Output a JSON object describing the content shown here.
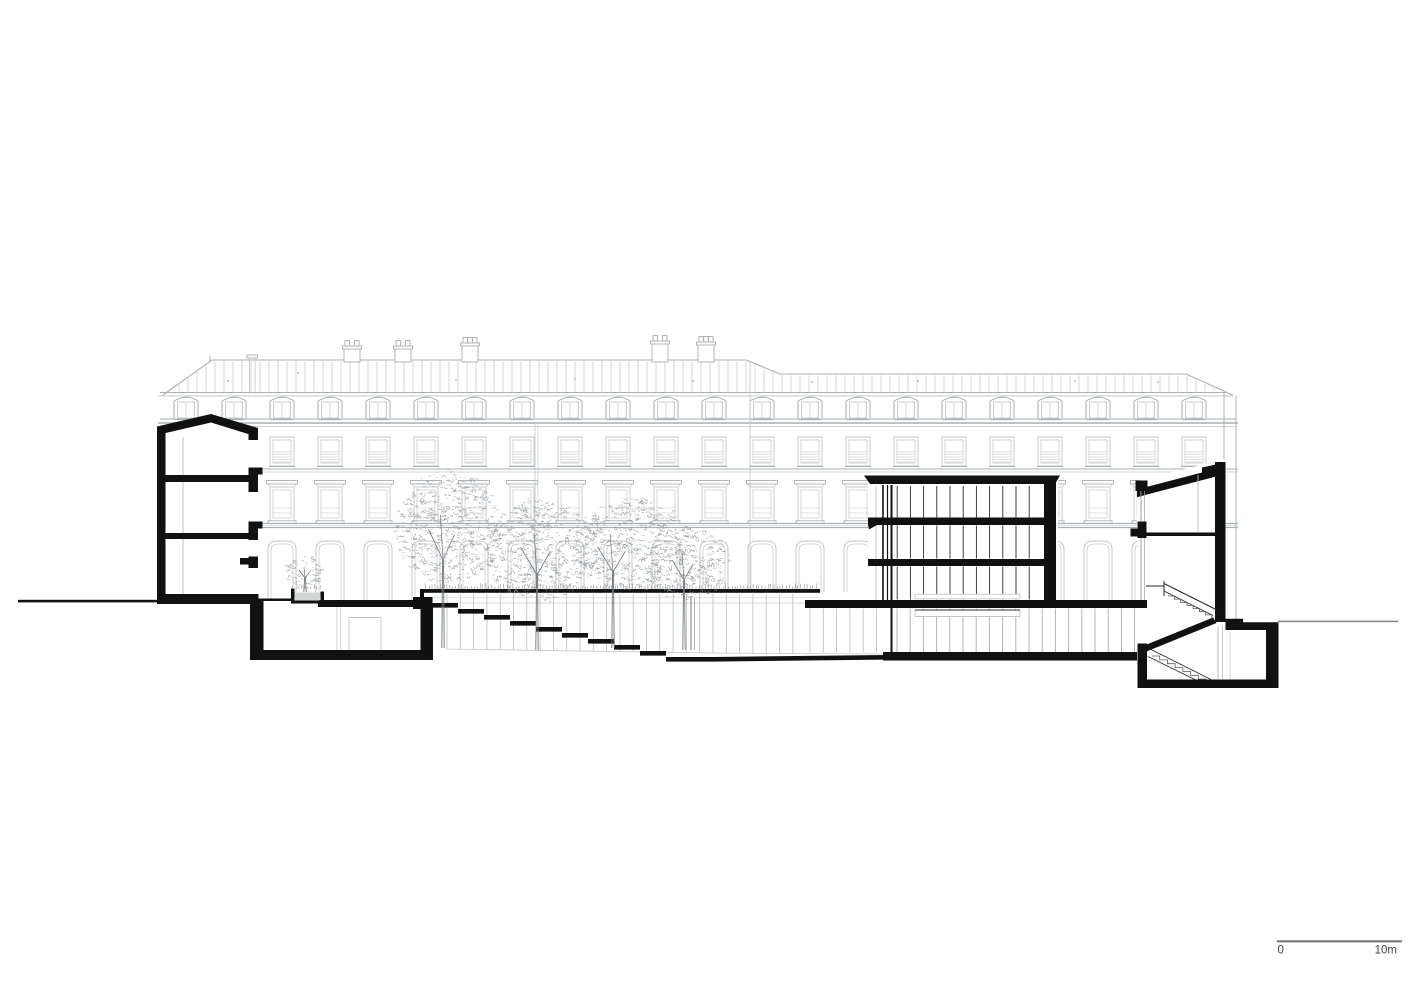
{
  "scale_bar": {
    "start_label": "0",
    "end_label": "10m"
  },
  "colors": {
    "background": "#ffffff",
    "cut_black": "#111111",
    "elevation_gray": "#c3c7ca",
    "elevation_dark_gray": "#aaafb2",
    "glazing_gray": "#9aa0a3",
    "basement_mullion_gray": "#a9adb0",
    "foliage_gray": "#8f9498",
    "trunk_gray": "#6f7477",
    "planter_gray": "#d3d5d6",
    "ground_line_black": "#141414",
    "ground_line_gray": "#85898c",
    "scale_line_gray": "#74787b",
    "scale_text_gray": "#3f4244"
  }
}
